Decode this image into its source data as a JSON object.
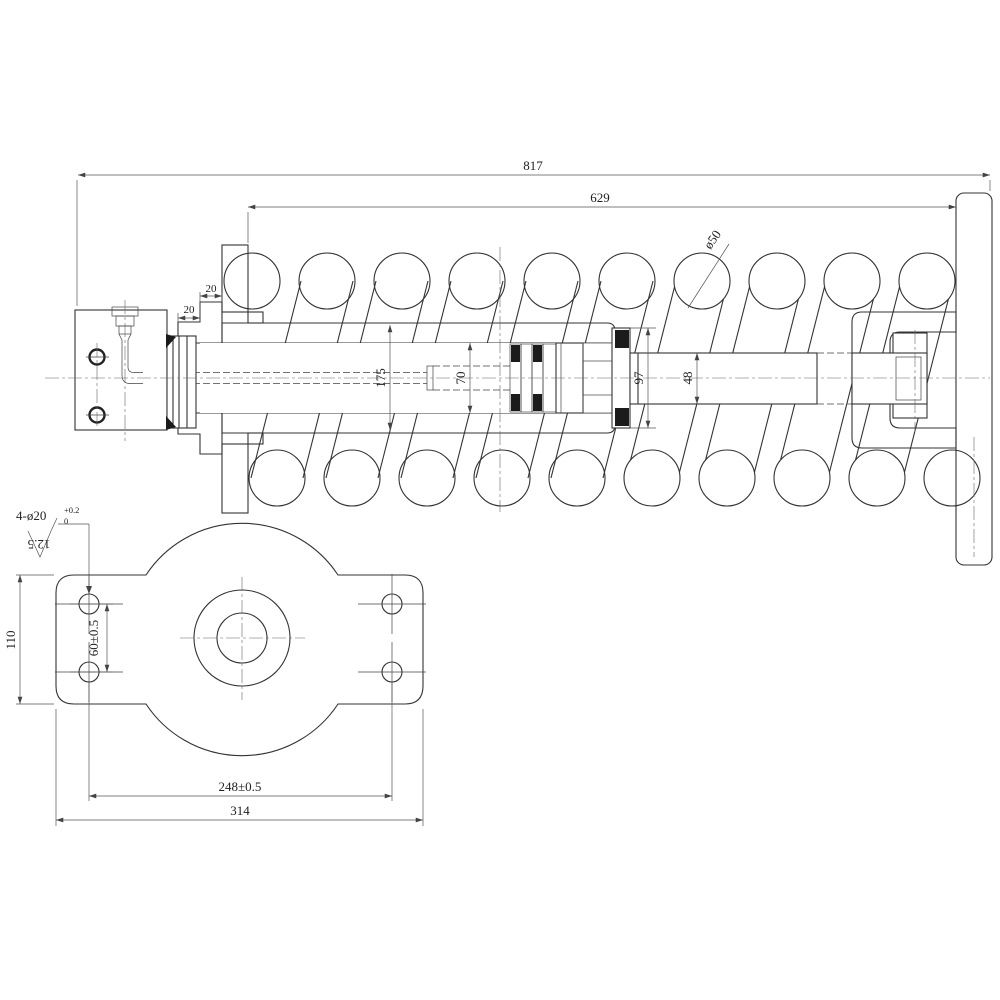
{
  "drawing": {
    "type": "engineering-drawing",
    "part": "recoil spring cylinder assembly",
    "views": {
      "main": "side-section-view",
      "secondary": "bottom-plate-view"
    }
  },
  "dimensions": {
    "overall_length": "817",
    "spring_length": "629",
    "spring_wire_dia": "ø50",
    "flange_step_a": "20",
    "flange_step_b": "20",
    "barrel_od": "175",
    "bore_dia": "70",
    "gland_dia": "97",
    "rod_dia": "48",
    "bolt_holes": "4-ø20",
    "bolt_holes_tol_upper": "+0.2",
    "bolt_holes_tol_lower": "0",
    "surface_roughness": "12.5",
    "plate_height": "110",
    "hole_spacing_vertical": "60±0.5",
    "hole_spacing_horizontal": "248±0.5",
    "plate_width": "314"
  }
}
